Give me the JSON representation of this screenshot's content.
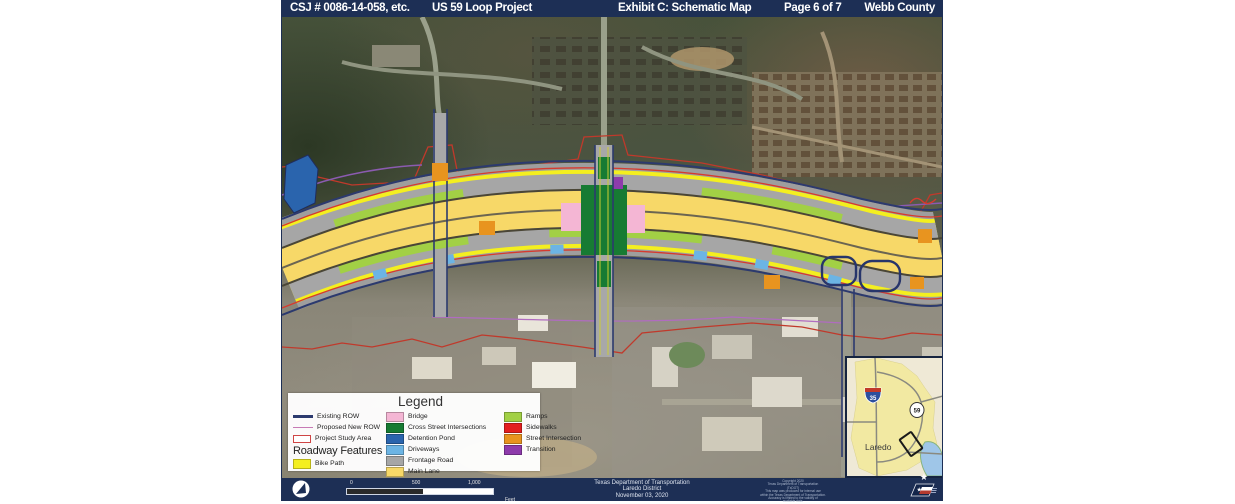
{
  "header": {
    "csj": "CSJ # 0086-14-058, etc.",
    "project": "US 59 Loop Project",
    "exhibit": "Exhibit C: Schematic Map",
    "page": "Page 6 of 7",
    "county": "Webb County"
  },
  "legend": {
    "title": "Legend",
    "col1": [
      {
        "label": "Existing ROW",
        "color": "#2c3a6e"
      },
      {
        "label": "Proposed New ROW",
        "color": "#c77ab5"
      },
      {
        "label": "Project Study Area",
        "color": "#cf4545"
      }
    ],
    "roadway_heading": "Roadway Features",
    "bike_path": {
      "label": "Bike Path",
      "color": "#f4ef1f"
    },
    "col2": [
      {
        "label": "Bridge",
        "color": "#f4b6d4"
      },
      {
        "label": "Cross Street Intersections",
        "color": "#177b33"
      },
      {
        "label": "Detention Pond",
        "color": "#2a64ad"
      },
      {
        "label": "Driveways",
        "color": "#6cb4e4"
      },
      {
        "label": "Frontage Road",
        "color": "#a6a6a6"
      },
      {
        "label": "Main Lane",
        "color": "#f7d868"
      }
    ],
    "col3": [
      {
        "label": "Ramps",
        "color": "#a2d045"
      },
      {
        "label": "Sidewalks",
        "color": "#e31f1f"
      },
      {
        "label": "Street Intersection",
        "color": "#e8941f"
      },
      {
        "label": "Transition",
        "color": "#8e3bab"
      }
    ]
  },
  "inset": {
    "city": "Laredo",
    "interstate": "35",
    "us_route": "59"
  },
  "footer": {
    "scale": {
      "t0": "0",
      "t500": "500",
      "t1000": "1,000",
      "unit": "Feet"
    },
    "agency": "Texas Department of Transportation",
    "district": "Laredo District",
    "date": "November 03, 2020",
    "fineprint": [
      "Copyright 2020",
      "Texas Department of Transportation",
      "(TxDOT)",
      "This map was produced for internal use",
      "within the Texas Department of Transportation.",
      "Accuracy is limited to the validity of",
      "available data."
    ]
  },
  "colors": {
    "banner_navy": "#1d2f55",
    "page_bg": "#ffffff"
  }
}
